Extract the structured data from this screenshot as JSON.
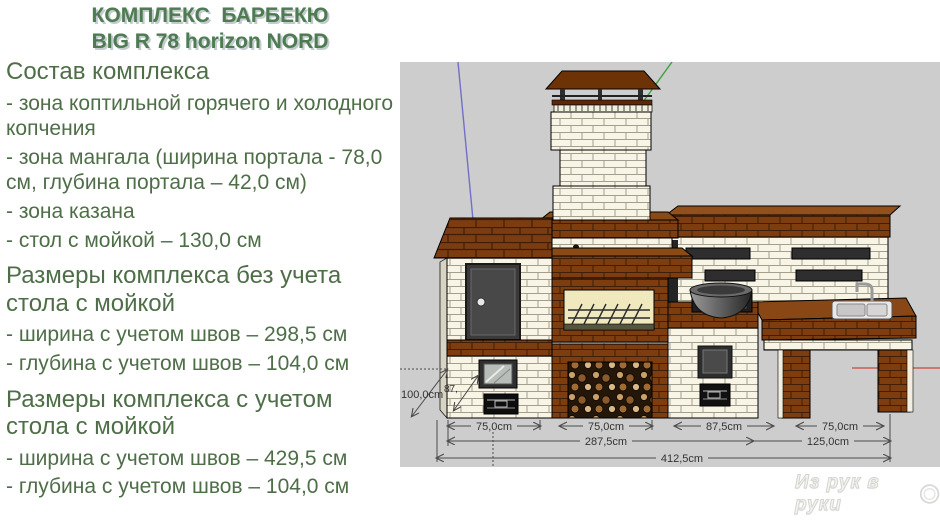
{
  "title": {
    "line1": "КОМПЛЕКС  БАРБЕКЮ",
    "line2": "BIG R 78 horizon NORD"
  },
  "info": {
    "sections": [
      {
        "heading": "Состав комплекса",
        "items": [
          "- зона коптильной горячего и холодного копчения",
          "- зона мангала (ширина портала - 78,0 см, глубина портала – 42,0 см)",
          "- зона казана",
          "- стол с мойкой – 130,0 см"
        ]
      },
      {
        "heading": "Размеры комплекса без учета стола с мойкой",
        "items": [
          "- ширина с учетом швов – 298,5 см",
          "- глубина с учетом швов – 104,0 см"
        ]
      },
      {
        "heading": "Размеры комплекса с учетом стола с мойкой",
        "items": [
          "- ширина с учетом швов – 429,5 см",
          "- глубина с учетом швов – 104,0 см"
        ]
      }
    ]
  },
  "diagram": {
    "dims": {
      "height": "100,0cm",
      "depth": "87,",
      "w_smoker": "75,0cm",
      "w_wood": "75,0cm",
      "w_kazan": "87,5cm",
      "w_table_leg": "75,0cm",
      "w_main": "287,5cm",
      "w_table": "125,0cm",
      "w_total": "412,5cm"
    },
    "colors": {
      "viewport_bg": "#cdcdcd",
      "brick_light": "#f8f5e6",
      "brick_brown": "#7d3d0e",
      "axis_blue": "#7070c8",
      "axis_green": "#3da03d",
      "axis_red": "#c86050"
    }
  },
  "watermark": {
    "text": "Из рук в руки"
  }
}
